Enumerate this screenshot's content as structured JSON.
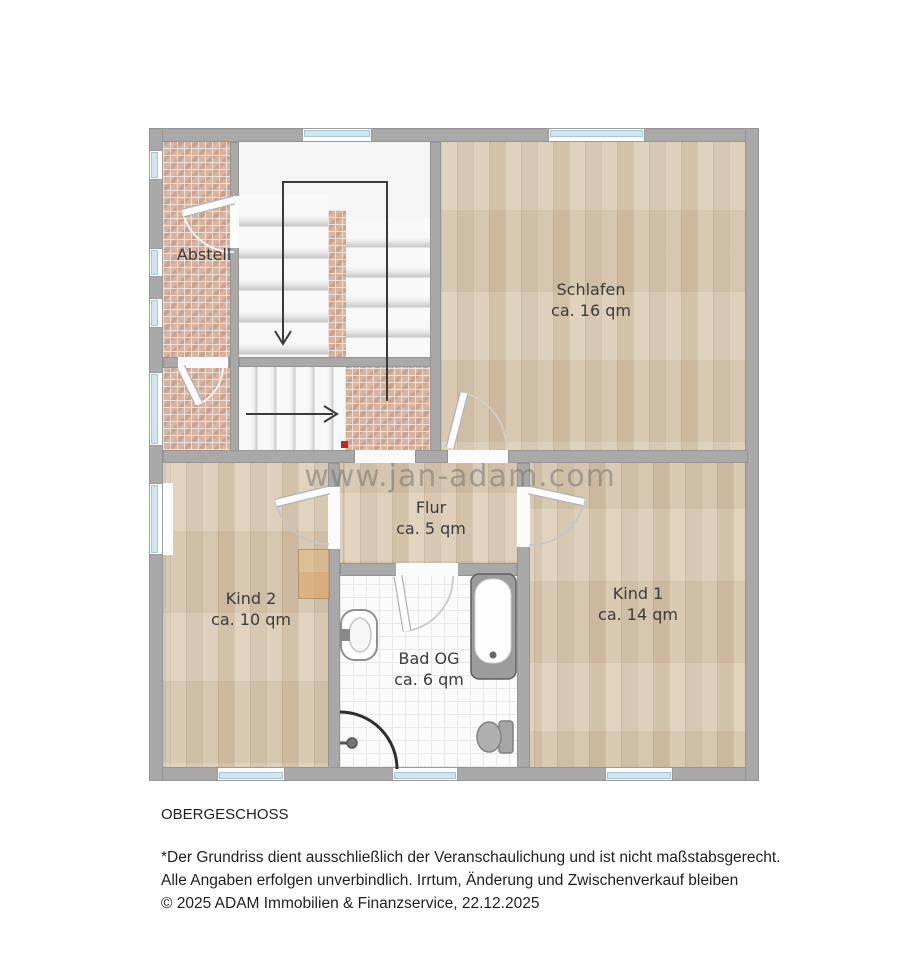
{
  "plan": {
    "watermark": "www.jan-adam.com",
    "rooms": [
      {
        "name": "Abstell",
        "area": ""
      },
      {
        "name": "Schlafen",
        "area": "ca. 16 qm"
      },
      {
        "name": "Flur",
        "area": "ca. 5 qm"
      },
      {
        "name": "Kind 2",
        "area": "ca. 10 qm"
      },
      {
        "name": "Bad OG",
        "area": "ca. 6 qm"
      },
      {
        "name": "Kind 1",
        "area": "ca. 14 qm"
      }
    ],
    "colors": {
      "wall": "#a9a9a9",
      "window_glass": "#cfe6f1",
      "tile_pink": "#d7b3a0",
      "wood_floor": "#d9cbb5",
      "bath_tile": "#fbfbfb",
      "marker_red": "#c22525",
      "label_text": "#3b3b3b",
      "watermark_gray": "#767676"
    }
  },
  "footer": {
    "title": "OBERGESCHOSS",
    "lines": [
      "*Der Grundriss dient ausschließlich der Veranschaulichung und ist nicht maßstabsgerecht.",
      "Alle Angaben erfolgen unverbindlich. Irrtum, Änderung und Zwischenverkauf bleiben",
      "© 2025 ADAM Immobilien & Finanzservice, 22.12.2025"
    ]
  }
}
